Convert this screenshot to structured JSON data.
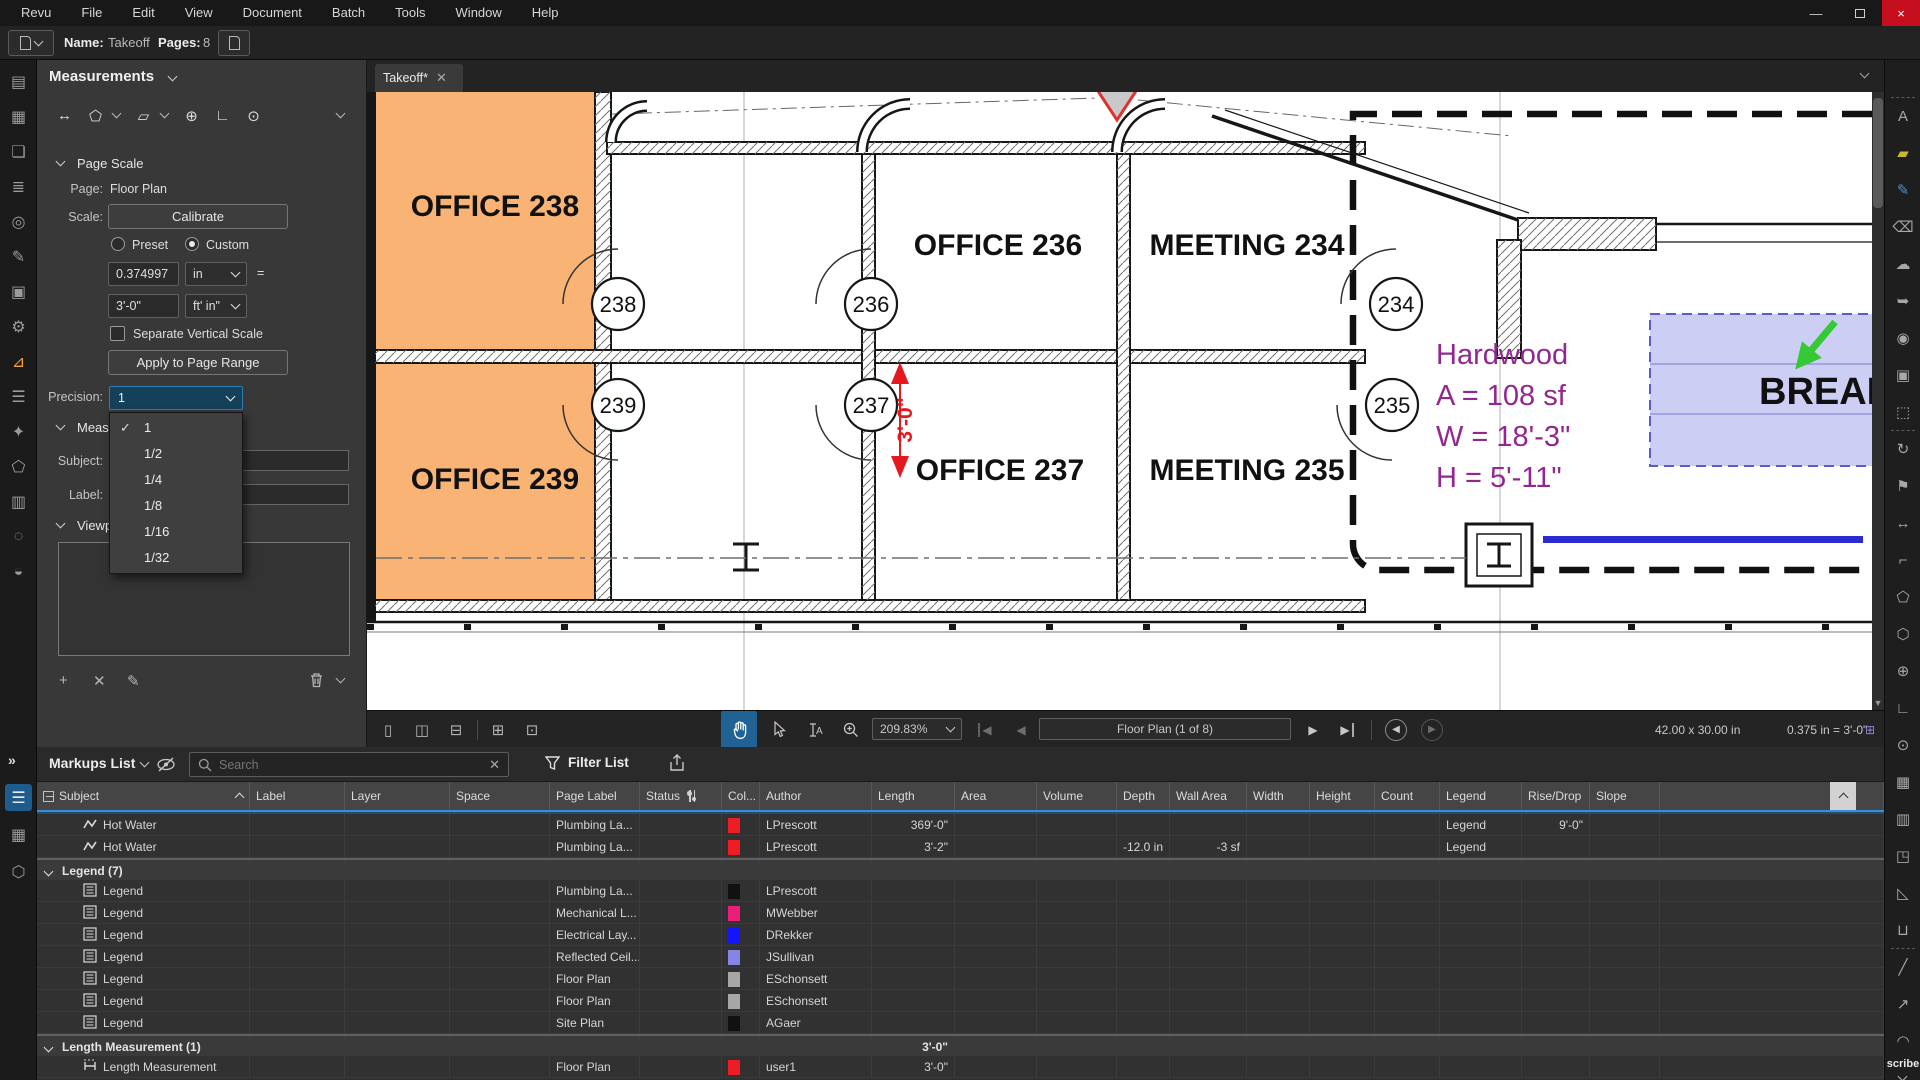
{
  "titlebar": {
    "menu": [
      "Revu",
      "File",
      "Edit",
      "View",
      "Document",
      "Batch",
      "Tools",
      "Window",
      "Help"
    ]
  },
  "doc_toolbar": {
    "name_label": "Name:",
    "name_value": "Takeoff",
    "pages_label": "Pages:",
    "pages_value": "8"
  },
  "left_strip": {
    "items": [
      {
        "name": "file-access-icon",
        "glyph": "▤"
      },
      {
        "name": "thumbnails-icon",
        "glyph": "▦"
      },
      {
        "name": "bookmarks-icon",
        "glyph": "❏"
      },
      {
        "name": "layers-icon",
        "glyph": "≣"
      },
      {
        "name": "spaces-icon",
        "glyph": "◎"
      },
      {
        "name": "markups-panel-icon",
        "glyph": "✎"
      },
      {
        "name": "tool-chest-icon",
        "glyph": "▣"
      },
      {
        "name": "properties-icon",
        "glyph": "⚙"
      },
      {
        "name": "measurements-panel-icon",
        "glyph": "⊿",
        "active": true
      },
      {
        "name": "markups-list-icon",
        "glyph": "☰"
      },
      {
        "name": "tool-sets-icon",
        "glyph": "✦"
      },
      {
        "name": "shapes-icon",
        "glyph": "⬠"
      },
      {
        "name": "stacks-icon",
        "glyph": "▥"
      },
      {
        "name": "search-icon",
        "glyph": "◌"
      },
      {
        "name": "studio-icon",
        "glyph": "◒"
      }
    ],
    "bottom_items": [
      {
        "name": "markups-list-view-icon",
        "glyph": "☰",
        "activebg": true
      },
      {
        "name": "thumbnails-view-icon",
        "glyph": "▦"
      },
      {
        "name": "model-3d-icon",
        "glyph": "⬡"
      }
    ],
    "expand_glyph": "»"
  },
  "left_panel": {
    "title": "Measurements",
    "check_glyph": "✓",
    "tools": [
      {
        "name": "measure-length-tool-icon",
        "glyph": "↔"
      },
      {
        "name": "measure-area-tool-icon",
        "glyph": "⬠",
        "dd": true
      },
      {
        "name": "measure-volume-tool-icon",
        "glyph": "▱",
        "dd": true
      },
      {
        "name": "measure-diameter-tool-icon",
        "glyph": "⊕"
      },
      {
        "name": "measure-angle-tool-icon",
        "glyph": "∟"
      },
      {
        "name": "measure-radius-tool-icon",
        "glyph": "⊙"
      }
    ],
    "page_scale": {
      "section": "Page Scale",
      "page_label": "Page:",
      "page_value": "Floor Plan",
      "scale_label": "Scale:",
      "calibrate": "Calibrate",
      "preset": "Preset",
      "custom": "Custom",
      "scale_value": "0.374997",
      "scale_unit": "in",
      "equals": "=",
      "scale_to_value": "3'-0\"",
      "scale_to_unit": "ft' in\"",
      "separate_vertical": "Separate Vertical Scale",
      "apply": "Apply to Page Range",
      "precision_label": "Precision:",
      "precision_value": "1"
    },
    "precision_options": [
      "1",
      "1/2",
      "1/4",
      "1/8",
      "1/16",
      "1/32"
    ],
    "measurements_section": "Measurements",
    "subject_label": "Subject:",
    "label_label": "Label:",
    "viewports_section": "Viewports"
  },
  "tabbar": {
    "active_tab": "Takeoff*"
  },
  "canvas": {
    "fill_color": "#F9B374",
    "highlight_color": "#CDCEF4",
    "room_labels": {
      "r238": "OFFICE 238",
      "r236": "OFFICE 236",
      "r234": "MEETING 234",
      "r239": "OFFICE 239",
      "r237": "OFFICE 237",
      "r235": "MEETING 235"
    },
    "door_numbers": {
      "d238": "238",
      "d239": "239",
      "d236": "236",
      "d237": "237",
      "d234": "234",
      "d235": "235"
    },
    "takeoff_annotation": {
      "material": "Hardwood",
      "area": "A = 108 sf",
      "width": "W = 18'-3\"",
      "height": "H = 5'-11\"",
      "color": "#92278F"
    },
    "break_room_label": "BREAK",
    "dimension_label": "3'-0\""
  },
  "statusbar": {
    "zoom_value": "209.83%",
    "page_indicator": "Floor Plan (1 of 8)",
    "page_size": "42.00 x 30.00 in",
    "page_scale": "0.375 in = 3'-0\""
  },
  "markups": {
    "title": "Markups List",
    "search_placeholder": "Search",
    "filter": "Filter List",
    "columns": [
      "Subject",
      "Label",
      "Layer",
      "Space",
      "Page Label",
      "Status",
      "Col...",
      "Author",
      "Length",
      "Area",
      "Volume",
      "Depth",
      "Wall Area",
      "Width",
      "Height",
      "Count",
      "Legend",
      "Rise/Drop",
      "Slope"
    ],
    "rows": [
      {
        "type": "item",
        "icon": "polyline",
        "subject": "Hot Water",
        "page_label": "Plumbing La...",
        "color": "#EE1C25",
        "author": "LPrescott",
        "length": "369'-0\"",
        "legend": "Legend",
        "rise_drop": "9'-0\""
      },
      {
        "type": "item",
        "icon": "polyline",
        "subject": "Hot Water",
        "page_label": "Plumbing La...",
        "color": "#EE1C25",
        "author": "LPrescott",
        "length": "3'-2\"",
        "depth": "-12.0 in",
        "wall_area": "-3 sf",
        "legend": "Legend"
      },
      {
        "type": "group",
        "subject": "Legend (7)"
      },
      {
        "type": "item",
        "icon": "legend",
        "subject": "Legend",
        "page_label": "Plumbing La...",
        "color": "#111111",
        "author": "LPrescott"
      },
      {
        "type": "item",
        "icon": "legend",
        "subject": "Legend",
        "page_label": "Mechanical L...",
        "color": "#EC1E79",
        "author": "MWebber"
      },
      {
        "type": "item",
        "icon": "legend",
        "subject": "Legend",
        "page_label": "Electrical Lay...",
        "color": "#1414FF",
        "author": "DRekker"
      },
      {
        "type": "item",
        "icon": "legend",
        "subject": "Legend",
        "page_label": "Reflected Ceil...",
        "color": "#8585E8",
        "author": "JSullivan"
      },
      {
        "type": "item",
        "icon": "legend",
        "subject": "Legend",
        "page_label": "Floor Plan",
        "color": "#A6A6A6",
        "author": "ESchonsett"
      },
      {
        "type": "item",
        "icon": "legend",
        "subject": "Legend",
        "page_label": "Floor Plan",
        "color": "#A6A6A6",
        "author": "ESchonsett"
      },
      {
        "type": "item",
        "icon": "legend",
        "subject": "Legend",
        "page_label": "Site Plan",
        "color": "#111111",
        "author": "AGaer"
      },
      {
        "type": "group",
        "subject": "Length Measurement (1)",
        "length": "3'-0\""
      },
      {
        "type": "item",
        "icon": "length",
        "subject": "Length Measurement",
        "page_label": "Floor Plan",
        "color": "#EE1C25",
        "author": "user1",
        "length": "3'-0\""
      }
    ]
  },
  "right_strip": {
    "items": [
      {
        "name": "text-box-icon",
        "glyph": "A",
        "sep": true
      },
      {
        "name": "highlight-icon",
        "glyph": "▰",
        "color": "#c8b830"
      },
      {
        "name": "pen-icon",
        "glyph": "✎",
        "color": "#4a90d8"
      },
      {
        "name": "eraser-icon",
        "glyph": "⌫"
      },
      {
        "name": "cloud-icon",
        "glyph": "☁"
      },
      {
        "name": "callout-icon",
        "glyph": "➥"
      },
      {
        "name": "stamp-icon",
        "glyph": "◉"
      },
      {
        "name": "image-icon",
        "glyph": "▣"
      },
      {
        "name": "snapshot-icon",
        "glyph": "⬚"
      },
      {
        "name": "measure-rotate-icon",
        "glyph": "↻",
        "sep": true
      },
      {
        "name": "count-tool-icon",
        "glyph": "⚑"
      },
      {
        "name": "length-tool-icon",
        "glyph": "↔"
      },
      {
        "name": "polylength-tool-icon",
        "glyph": "⌐"
      },
      {
        "name": "area-tool-icon",
        "glyph": "⬠"
      },
      {
        "name": "perimeter-tool-icon",
        "glyph": "⬡"
      },
      {
        "name": "diameter-tool-icon",
        "glyph": "⊕"
      },
      {
        "name": "angle-tool-icon",
        "glyph": "∟"
      },
      {
        "name": "radius-tool-icon",
        "glyph": "⊙"
      },
      {
        "name": "volume-tool-icon",
        "glyph": "▦"
      },
      {
        "name": "wall-area-tool-icon",
        "glyph": "▥"
      },
      {
        "name": "cutout-tool-icon",
        "glyph": "◳"
      },
      {
        "name": "slope-tool-icon",
        "glyph": "◺"
      },
      {
        "name": "width-tool-icon",
        "glyph": "⊔"
      },
      {
        "name": "line-tool-icon",
        "glyph": "╱",
        "sep": true
      },
      {
        "name": "arrow-tool-icon",
        "glyph": "↗"
      },
      {
        "name": "arc-tool-icon",
        "glyph": "◠"
      }
    ],
    "note": "scribe"
  }
}
